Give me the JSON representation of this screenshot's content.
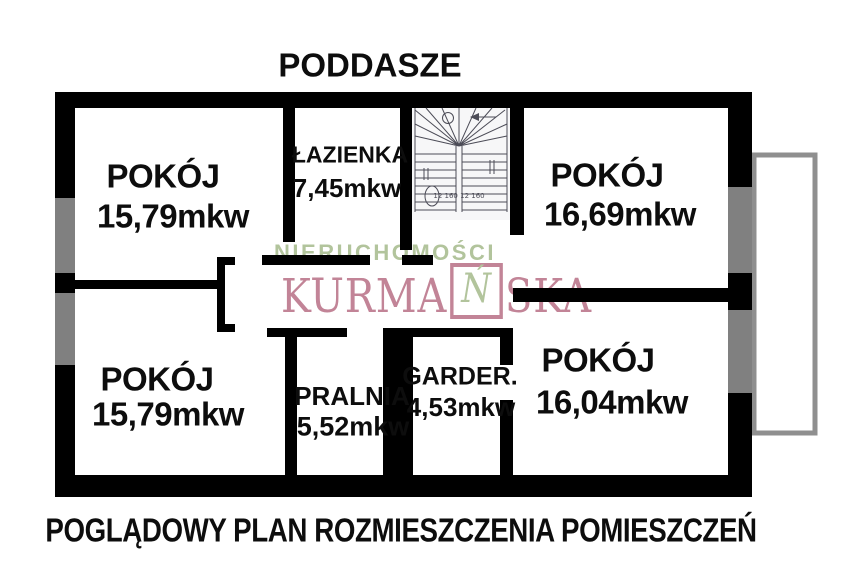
{
  "title": "PODDASZE",
  "caption": "POGLĄDOWY PLAN ROZMIESZCZENIA POMIESZCZEŃ",
  "watermark": {
    "line1": "NIERUCHOMOŚCI",
    "brand_prefix": "KURMA",
    "brand_boxed_letter": "Ń",
    "brand_suffix": "SKA"
  },
  "rooms": {
    "pokoj_top_left": {
      "name": "POKÓJ",
      "area": "15,79mkw"
    },
    "lazienka": {
      "name": "ŁAZIENKA",
      "area": "7,45mkw"
    },
    "pokoj_top_right": {
      "name": "POKÓJ",
      "area": "16,69mkw"
    },
    "pokoj_bottom_left": {
      "name": "POKÓJ",
      "area": "15,79mkw"
    },
    "pralnia": {
      "name": "PRALNIA",
      "area": "5,52mkw"
    },
    "garderoba": {
      "name": "GARDER.",
      "area": "4,53mkw"
    },
    "pokoj_bottom_right": {
      "name": "POKÓJ",
      "area": "16,04mkw"
    }
  },
  "stairs": {
    "dims_bottom": "12 160 12  160"
  },
  "colors": {
    "wall": "#000000",
    "window_gray": "#808080",
    "balcony_gray": "#8f8f8f",
    "brand_green": "#b2c49c",
    "brand_pink": "#c28497",
    "stairs_line": "#4c4c57"
  }
}
